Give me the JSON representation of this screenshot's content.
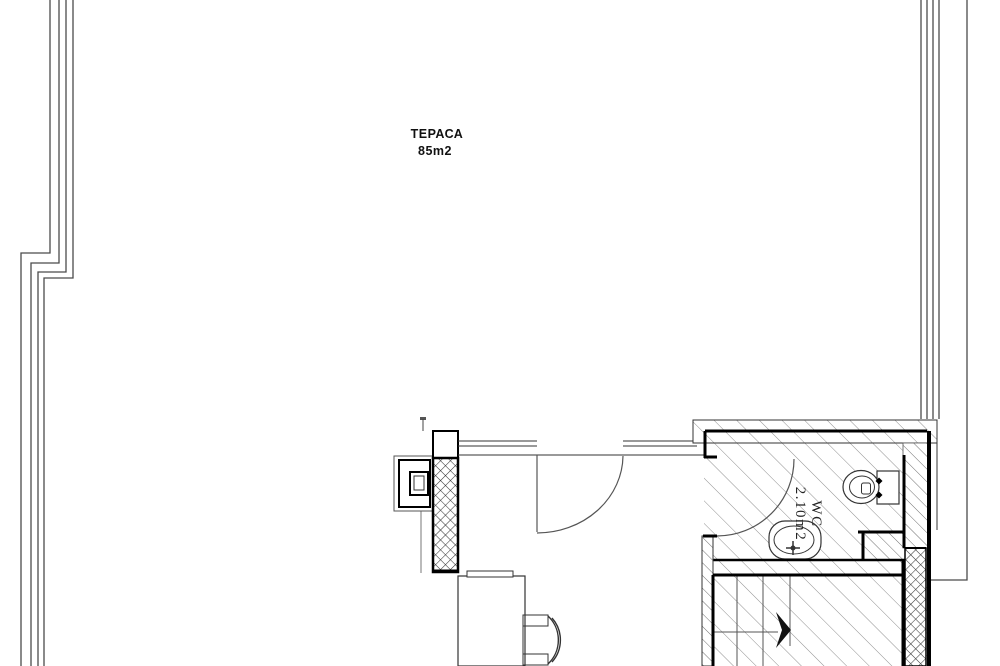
{
  "plan": {
    "terrace": {
      "name": "ТЕРАСА",
      "area": "85m2"
    },
    "wc": {
      "name": "WC",
      "area": "2.10m2"
    },
    "colors": {
      "background": "#ffffff",
      "thin_line": "#333333",
      "boundary_line": "#4b4b4b",
      "wall_line": "#000000",
      "hatch_floor": "#8f8f8f",
      "hatch_wall": "#6f6f6f",
      "crosshatch": "#3a3a3a"
    }
  }
}
